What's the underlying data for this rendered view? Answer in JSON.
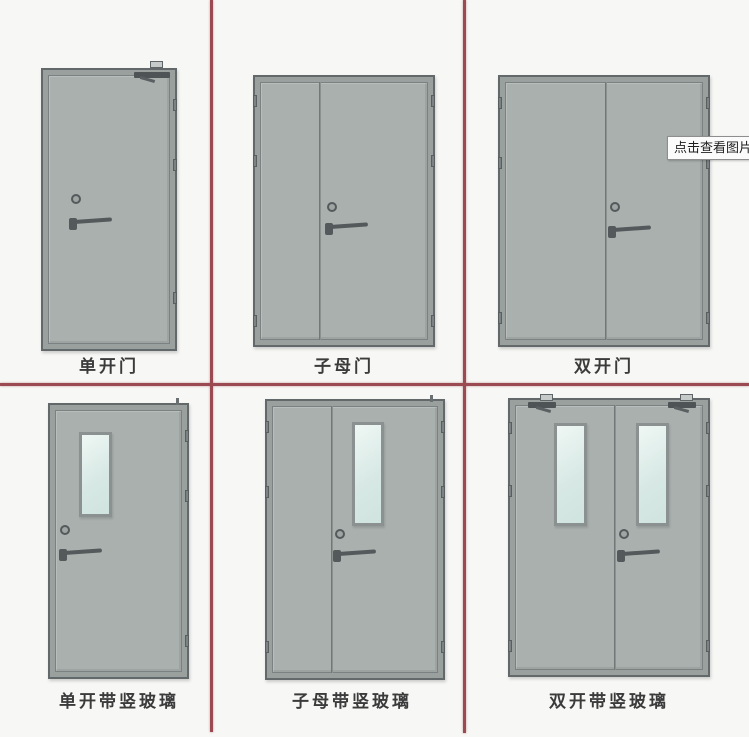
{
  "tooltip": {
    "text": "点击查看图片"
  },
  "cells": [
    {
      "label": "单开门",
      "type": "single-door"
    },
    {
      "label": "子母门",
      "type": "mother-child-door"
    },
    {
      "label": "双开门",
      "type": "double-door"
    },
    {
      "label": "单开带竖玻璃",
      "type": "single-door-vertical-glass"
    },
    {
      "label": "子母带竖玻璃",
      "type": "mother-child-door-vertical-glass"
    },
    {
      "label": "双开带竖玻璃",
      "type": "double-door-vertical-glass"
    }
  ],
  "theme": {
    "bg": "#f7f7f5",
    "grid-line": "#9a4a50",
    "frame": "#9aa09e",
    "frame-edge": "#63686a",
    "leaf": "#a9b0ae",
    "leaf-edge": "#7b8082",
    "hardware": "#54595b",
    "glass-edge": "#8b9190",
    "label-color": "#3b3b3b",
    "tooltip-bg": "#fbfbfb",
    "tooltip-border": "#8e8e8e",
    "tooltip-text": "#1f1f1f"
  }
}
